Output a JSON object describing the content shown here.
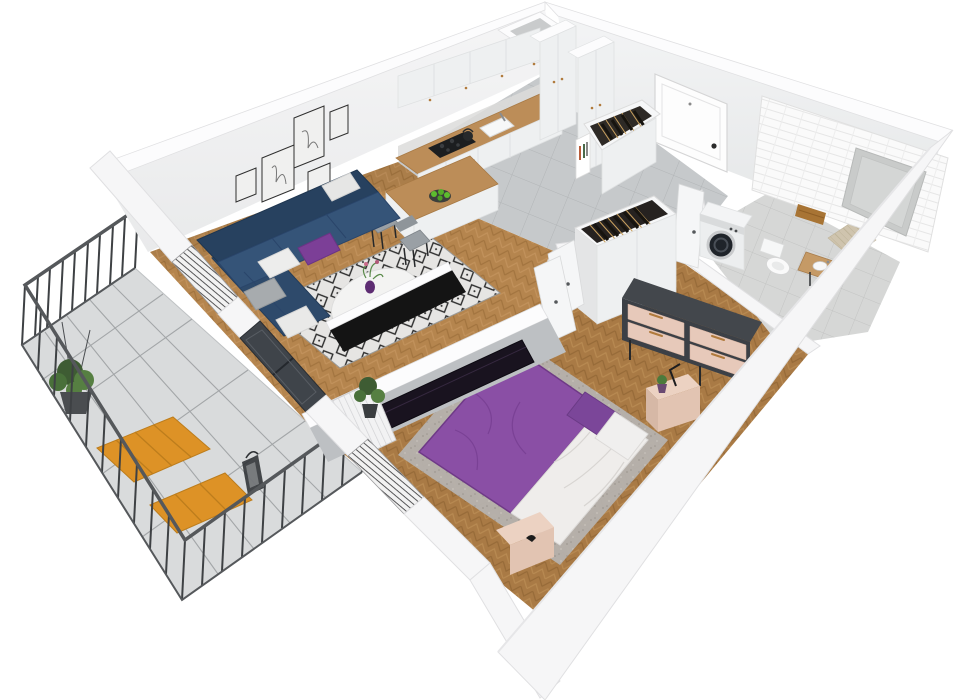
{
  "meta": {
    "description": "3D isometric cut-away floor plan render of a one-bedroom apartment with living room, kitchen, hallway, bathroom, bedroom and balcony",
    "view": "top-down axonometric render",
    "visible_text": "none"
  },
  "rooms": [
    {
      "id": "living-room",
      "label": "Living room",
      "floor": "chevron wood",
      "furniture": [
        "navy-corner-sofa",
        "throw-pillows",
        "round-coffee-table",
        "purple-vase",
        "diamond-rug",
        "gallery-wall-5-frames",
        "tv-on-partition"
      ]
    },
    {
      "id": "kitchen",
      "label": "Kitchen",
      "floor": "grey tile",
      "furniture": [
        "white-upper-cabinets",
        "white-base-cabinets",
        "wood-countertop",
        "cooktop",
        "oven",
        "sink",
        "kettle",
        "peninsula-bar",
        "fruit-plate",
        "two-chairs",
        "tall-cabinets"
      ]
    },
    {
      "id": "hallway",
      "label": "Hallway",
      "floor": "grey tile",
      "furniture": [
        "entry-door",
        "hanger-cabinet-with-clothes",
        "book-nook",
        "bathroom-door"
      ]
    },
    {
      "id": "bathroom",
      "label": "Bathroom",
      "floor": "light tile + herringbone accent",
      "furniture": [
        "washing-machine",
        "wall-hung-toilet",
        "wood-vanity-sink",
        "towel-rail",
        "subway-tile-wall",
        "window-niche"
      ]
    },
    {
      "id": "bedroom",
      "label": "Bedroom",
      "floor": "chevron wood",
      "furniture": [
        "double-bed-purple",
        "white-duvet",
        "pillows",
        "nightstand-with-lamp-and-plant",
        "foot-bench",
        "dresser-pink-drawers",
        "open-top-wardrobe-with-clothes",
        "wardrobe-door",
        "radiator",
        "potted-plant",
        "tv-partition"
      ]
    },
    {
      "id": "balcony",
      "label": "Balcony",
      "floor": "white tile grid",
      "furniture": [
        "metal-railing",
        "orange-wood-table",
        "orange-wood-bench",
        "hanging-plant",
        "lantern"
      ]
    }
  ],
  "colors": {
    "bg": "#ffffff",
    "wall": "#f6f6f7",
    "wallEdge": "#e0e0e2",
    "wallTop": "#fcfcfd",
    "wallFaceA": "#f4f4f5",
    "wallFaceB": "#e7e8ea",
    "partitionFace": "#bdc0c3",
    "woodLight": "#b5854e",
    "woodLine": "#a2743f",
    "woodLine2": "#c2925c",
    "woodBed": "#a97a45",
    "woodBedLine": "#966a38",
    "woodBedLine2": "#b88a52",
    "tile": "#c6c9cb",
    "tileLine": "#b2b5b7",
    "bathFloor": "#d6d7d6",
    "subway": "#fafafa",
    "subwayLine": "#e6e6e6",
    "counterWood": "#bc8d58",
    "counterEdge": "#a87a45",
    "cabinet": "#eef0f1",
    "cabinetLine": "#dfe1e2",
    "sofaDark": "#27415f",
    "sofaMid": "#2e4a6b",
    "sofaSeat": "#355478",
    "pillowWhite": "#ededec",
    "pillowGray": "#a7abae",
    "pillowPurple": "#7c3f97",
    "rugBase": "#e6e5e3",
    "rugInk": "#2c2c2c",
    "bedRug": "#b6b2ae",
    "tableWhite": "#f3f3f2",
    "vasePurple": "#5d2c72",
    "tvBlack": "#19131f",
    "tvPanel": "#141414",
    "bedBase": "#ece9e7",
    "bedPurple": "#8a4fa5",
    "bedPurpleDark": "#6f3a87",
    "duvet": "#efedeb",
    "nightstand": "#ecd2c2",
    "nightstandDark": "#e2c4b2",
    "dresserFrame": "#3f4348",
    "drawerPink": "#e7c9ba",
    "handleWood": "#b07a3c",
    "wardrobeDark": "#262220",
    "hangerGold": "#c9a05e",
    "clothesDark": "#17140f",
    "washerWhite": "#eceeef",
    "washerDoor": "#1f242a",
    "toiletWhite": "#fafafa",
    "vanityWood": "#c59a66",
    "towel": "#a87434",
    "glass": "#3f444a",
    "winStripe": "#3c3c3e",
    "railing": "#3e4144",
    "railTop": "#55585b",
    "balconyTile": "#d9dbdc",
    "balconyLine": "#a3a6a8",
    "balconyWood": "#dd9226",
    "balconyWoodLine": "#bd7d1c",
    "plantGreen": "#567f42",
    "plantDark": "#3e5c33",
    "niche": "#c9cbca",
    "accent": "#cfc4ae",
    "accentLine": "#bfb49a",
    "radiator": "#f2f2f3",
    "radiatorLine": "#cfd0d2",
    "chairSeat": "#9aa0a5",
    "chairBack": "#8f959a",
    "legDark": "#26282a",
    "fruitGreen": "#5dbd2e",
    "plateDark": "#3c3f3c"
  }
}
